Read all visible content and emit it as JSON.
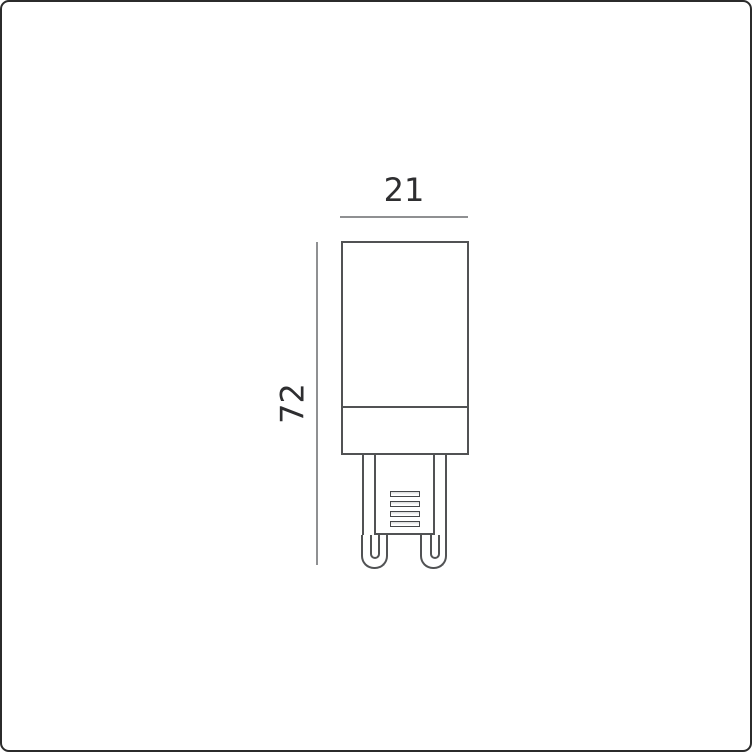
{
  "dimensions": {
    "width": {
      "label": "21"
    },
    "height": {
      "label": "72"
    }
  },
  "colors": {
    "background": "#ffffff",
    "outline": "#515254",
    "dimension_line": "#8f9092",
    "dimension_text": "#2e2e30",
    "page_border": "#2b2b2b"
  },
  "diagram": {
    "vent_slot_count": 4
  }
}
